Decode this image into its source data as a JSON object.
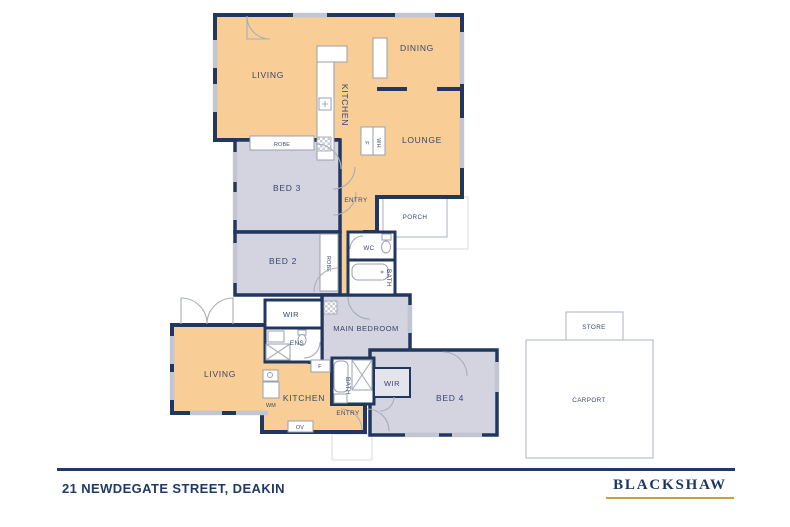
{
  "colors": {
    "living_fill": "#F8CE96",
    "bedroom_fill": "#D4D4E0",
    "wall_navy": "#22375F",
    "label_text": "#38456E",
    "outline_light": "#B9BEC9",
    "window_gray": "#C2C6D0",
    "brand_navy": "#1C3664",
    "brand_gold": "#C79F3D"
  },
  "rooms": {
    "living1": "LIVING",
    "kitchen1": "KITCHEN",
    "dining": "DINING",
    "lounge": "LOUNGE",
    "robe1": "ROBE",
    "bed3": "BED 3",
    "robe2": "ROBE",
    "bed2": "BED 2",
    "entry1": "ENTRY",
    "porch": "PORCH",
    "wc": "WC",
    "bath1": "BATH",
    "wir1": "WIR",
    "main_bedroom": "MAIN BEDROOM",
    "ens": "ENS",
    "living2": "LIVING",
    "kitchen2": "KITCHEN",
    "bath2": "BATH",
    "wir2": "WIR",
    "bed4": "BED 4",
    "entry2": "ENTRY",
    "store": "STORE",
    "carport": "CARPORT"
  },
  "appliances": {
    "fridge1": "F",
    "water_heater": "WH",
    "fridge2": "F",
    "washing_machine": "WM",
    "oven": "OV"
  },
  "footer": {
    "address": "21 NEWDEGATE STREET, DEAKIN",
    "brand": "BLACKSHAW"
  }
}
